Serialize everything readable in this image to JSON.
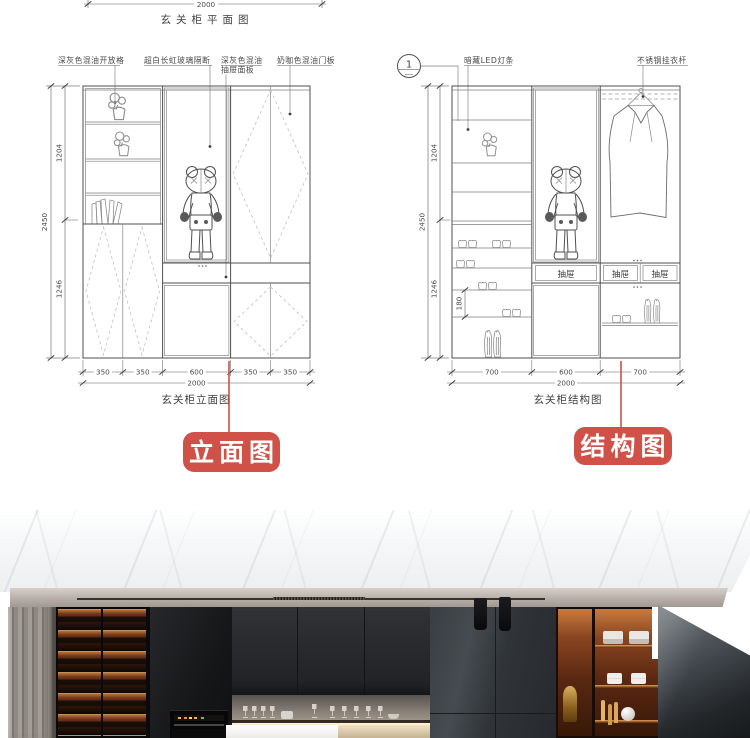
{
  "colors": {
    "badge_red": "#cf5148",
    "cad_line": "#4f4f4f",
    "display_amber": "#8a4520"
  },
  "plan_view": {
    "caption": "玄关柜平面图",
    "dim_total": "2000"
  },
  "elevation": {
    "caption": "玄关柜立面图",
    "badge_label": "立面图",
    "callouts": {
      "open_shelf": "深灰色混油开放格",
      "glass_partition": "超白长虹玻璃隔断",
      "drawer_panel_line1": "深灰色混油",
      "drawer_panel_line2": "抽屉面板",
      "door_panel": "奶咖色混油门板"
    },
    "dims": {
      "height_total": "2450",
      "height_upper": "1204",
      "height_lower": "1246",
      "bottom": [
        "350",
        "350",
        "600",
        "350",
        "350"
      ],
      "width_total": "2000"
    }
  },
  "structure": {
    "caption": "玄关柜结构图",
    "badge_label": "结构图",
    "detail_bubble": "1",
    "callouts": {
      "led_strip": "暗藏LED灯条",
      "clothes_rod": "不锈钢挂衣杆"
    },
    "drawer_labels": [
      "抽屉",
      "抽屉",
      "抽屉"
    ],
    "dims": {
      "height_total": "2450",
      "height_upper": "1204",
      "height_lower": "1246",
      "shelf_gap": "180",
      "bottom": [
        "700",
        "600",
        "700"
      ],
      "width_total": "2000"
    }
  }
}
